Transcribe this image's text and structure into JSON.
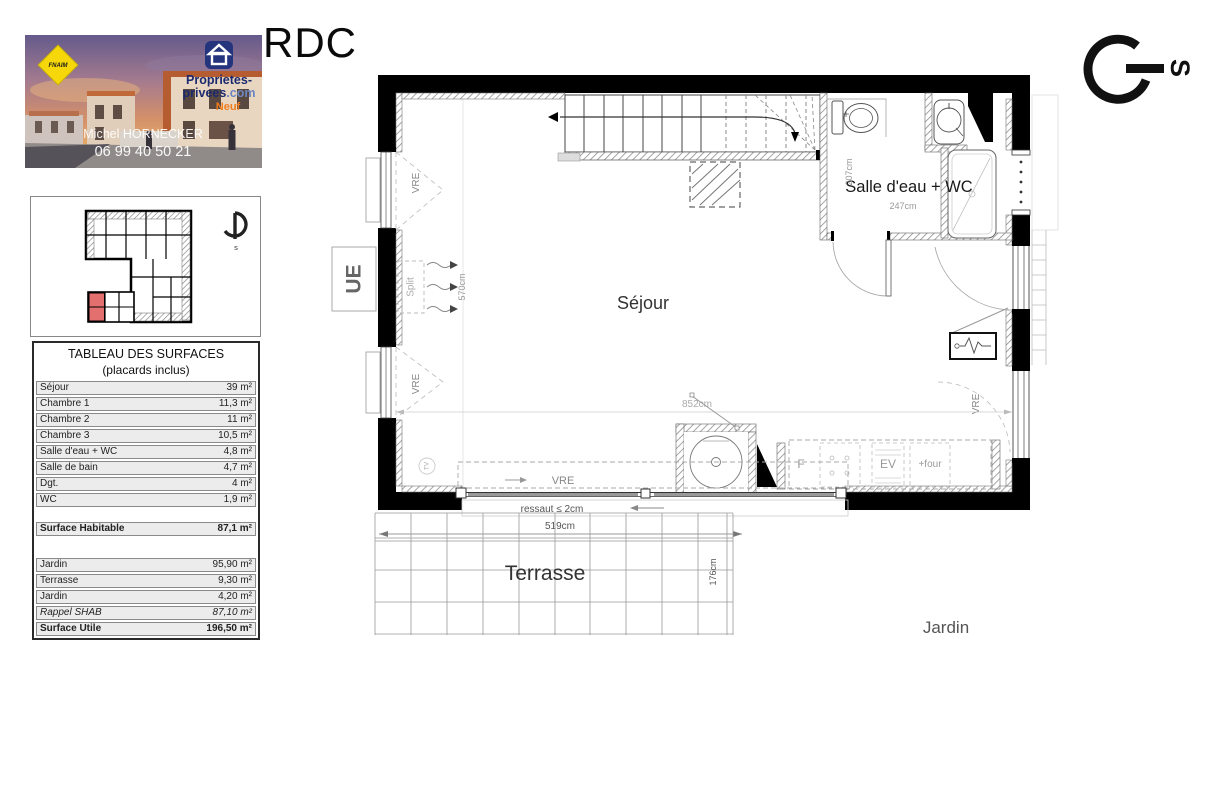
{
  "page": {
    "floor_title": "RDC"
  },
  "photo": {
    "fnaim": "FNAIM",
    "brand_line1": "Proprietes-",
    "brand_line2": "privees",
    "brand_suffix": ".com",
    "brand_tag": "Neuf",
    "agent_name": "Michel HORNECKER",
    "agent_phone": "06 99 40 50 21"
  },
  "surface_table": {
    "title": "TABLEAU DES SURFACES",
    "subtitle": "(placards inclus)",
    "rows": [
      {
        "label": "Séjour",
        "value": "39 m²"
      },
      {
        "label": "Chambre 1",
        "value": "11,3 m²"
      },
      {
        "label": "Chambre 2",
        "value": "11 m²"
      },
      {
        "label": "Chambre 3",
        "value": "10,5 m²"
      },
      {
        "label": "Salle d'eau + WC",
        "value": "4,8 m²"
      },
      {
        "label": "Salle de bain",
        "value": "4,7 m²"
      },
      {
        "label": "Dgt.",
        "value": "4 m²"
      },
      {
        "label": "WC",
        "value": "1,9 m²"
      }
    ],
    "habitable": {
      "label": "Surface Habitable",
      "value": "87,1 m²"
    },
    "annex_rows": [
      {
        "label": "Jardin",
        "value": "95,90 m²"
      },
      {
        "label": "Terrasse",
        "value": "9,30 m²"
      },
      {
        "label": "Jardin",
        "value": "4,20 m²"
      },
      {
        "label": "Rappel  SHAB",
        "value": "87,10 m²"
      },
      {
        "label": "Surface Utile",
        "value": "196,50 m²"
      }
    ]
  },
  "floor_plan": {
    "rooms": {
      "sejour": "Séjour",
      "salle_eau": "Salle d'eau + WC",
      "terrasse": "Terrasse",
      "jardin": "Jardin"
    },
    "equipment": {
      "ue": "UE",
      "split": "Split",
      "vre": "VRE",
      "tv": "TV",
      "fridge": "F",
      "sink": "EV",
      "oven": "+four"
    },
    "annotations": {
      "ressaut": "ressaut ≤ 2cm",
      "compass_south": "S",
      "compass_south_small": "s"
    },
    "dimensions": {
      "d207": "207cm",
      "d247": "247cm",
      "d852": "852cm",
      "d570": "570cm",
      "d519": "519cm",
      "d176": "176cm"
    }
  }
}
